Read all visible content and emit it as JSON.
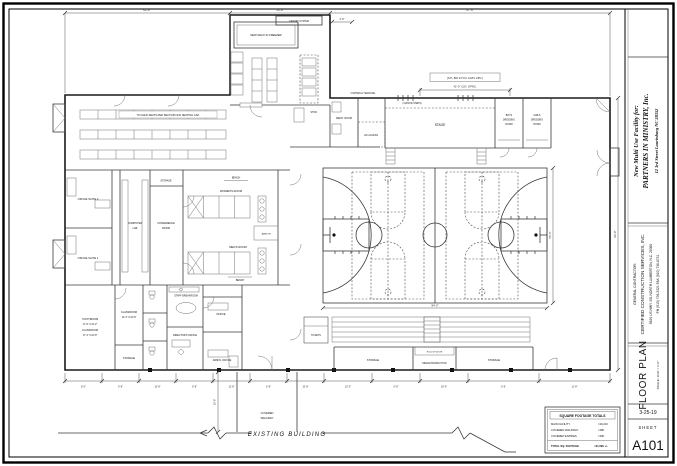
{
  "sheet": {
    "project": {
      "line1": "New Multi Use Facility for:",
      "line2": "PARTNERS IN MINISTRY, Inc.",
      "line3": "12 3rd Street  Laurinburg NC 28352"
    },
    "contractor": {
      "heading": "GENERAL CONTRACTOR:",
      "name": "CERTIFIED CONSTRUCTION SERVICES, INC.",
      "address": "9820 US HWY 301 NORTH   LUMBERTON, N.C. 28360",
      "phone": "PH (910) 739-3321   FAX (910) 738-6731"
    },
    "drawing_title": "FLOOR PLAN",
    "scale": "SCALE:  1/16\" = 1'-0\"",
    "date": "3-25-19",
    "sheet_word": "SHEET",
    "number": "A101"
  },
  "sqft": {
    "title": "SQUARE FOOTAGE TOTALS",
    "rows": [
      {
        "label": "MAIN FACILITY",
        "value": "=20,216"
      },
      {
        "label": "COVERED WALKWAY",
        "value": "=480"
      },
      {
        "label": "COVERED ENTRIES",
        "value": "=400"
      },
      {
        "label": "TOTAL SQ. FOOTAGE",
        "value": "=21,096 +/-"
      }
    ]
  },
  "plan": {
    "labels": {
      "freezer": "NEW WALK IN FREEZER",
      "canopy": "CANOPY SYSTEM",
      "seating_note": "70 CHILD SEATS PER SECTION=210 SEATING CAP.",
      "suite2": "OFFICE SUITE 2",
      "suite1": "OFFICE SUITE 1",
      "lab1": "COMPUTER",
      "lab2": "LAB",
      "conf1": "CONFERENCE",
      "conf2": "ROOM",
      "womens": "WOMEN'S ROOM",
      "mens": "MEN'S ROOM",
      "bench": "BENCH",
      "janitor": "JANITOR",
      "youth1": "YOUTHROOM",
      "youth2": "17'-6\" X 24'-2\"",
      "youth3": "CLASSROOM",
      "youth4": "17'-4\" X 22'-8\"",
      "class1": "CLASSROOM",
      "class2": "12'-4\" X 22'-8\"",
      "storage": "STORAGE",
      "breakroom": "STAFF BREAKROOM",
      "office": "OFFICE",
      "directors": "DIRECTOR'S OFFICE",
      "admin": "ADMIN. OFFICE",
      "stor": "STOR.",
      "mech": "MECH. ROOM",
      "ac": "A/C ACCESS",
      "curtain": "CURTAIN & TRACKING",
      "steps": "(4 WOOD STEPS)",
      "stage": "STAGE",
      "boys": "BOYS",
      "girls": "GIRLS",
      "dress": "DRESSING",
      "room": "ROOM",
      "tickets": "TICKETS",
      "media": "MEDIA PRODUCTION",
      "rollup": "ROLL UP DOOR",
      "cw1": "COVERED",
      "cw2": "WALKWAY",
      "existing": "EXISTING  BUILDING"
    },
    "dims": {
      "top1": "62'-8\"",
      "top2": "30'-8\"",
      "top3": "97'-6\"",
      "canopy": "6'-8\"",
      "note": "[STL BM 24\"OC GLB's ABV.]",
      "opening": "42'-0\" CLR. OPNG.",
      "court_w": "84'-0\"",
      "court_h": "50'-0\"",
      "right_v": "96'-8\"",
      "walkway": "10'-8\"",
      "bottom": [
        "8'-0\"",
        "6'-8\"",
        "10'-8\"",
        "6'-8\"",
        "12'-8\"",
        "6'-8\"",
        "10'-8\"",
        "22'-0\"",
        "6'-8\"",
        "18'-0\"",
        "6'-8\"",
        "11'-8\""
      ]
    }
  }
}
